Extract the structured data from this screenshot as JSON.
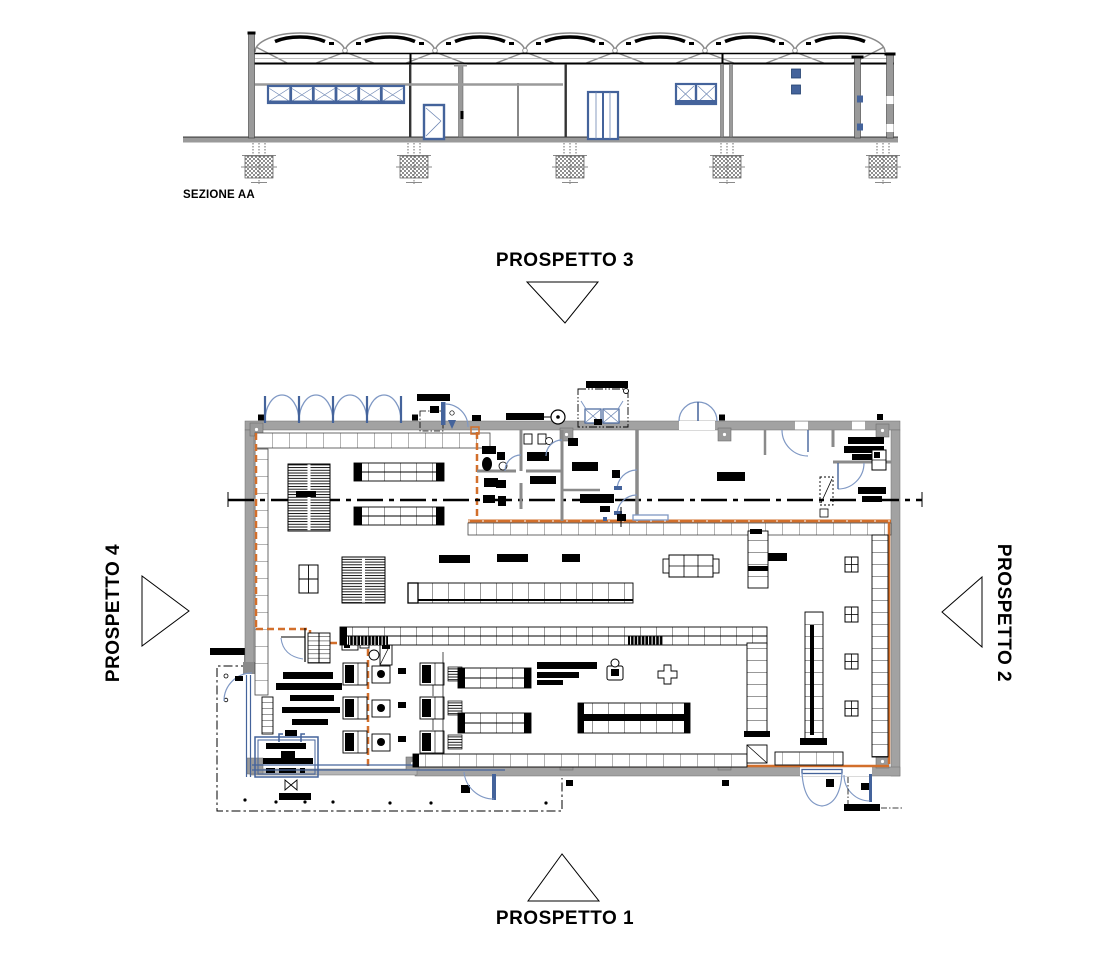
{
  "section": {
    "label": "SEZIONE AA"
  },
  "plan": {
    "markers": {
      "top": {
        "label": "PROSPETTO 3",
        "direction": "down"
      },
      "right": {
        "label": "PROSPETTO 2",
        "direction": "left"
      },
      "bottom": {
        "label": "PROSPETTO 1",
        "direction": "up"
      },
      "left": {
        "label": "PROSPETTO 4",
        "direction": "right"
      }
    }
  },
  "colors": {
    "paper": "#ffffff",
    "ink": "#000000",
    "wall_gray": "#a2a2a2",
    "steel_blue": "#44639b",
    "light_blue": "#7f98c4",
    "route_orange": "#d26f2b"
  }
}
